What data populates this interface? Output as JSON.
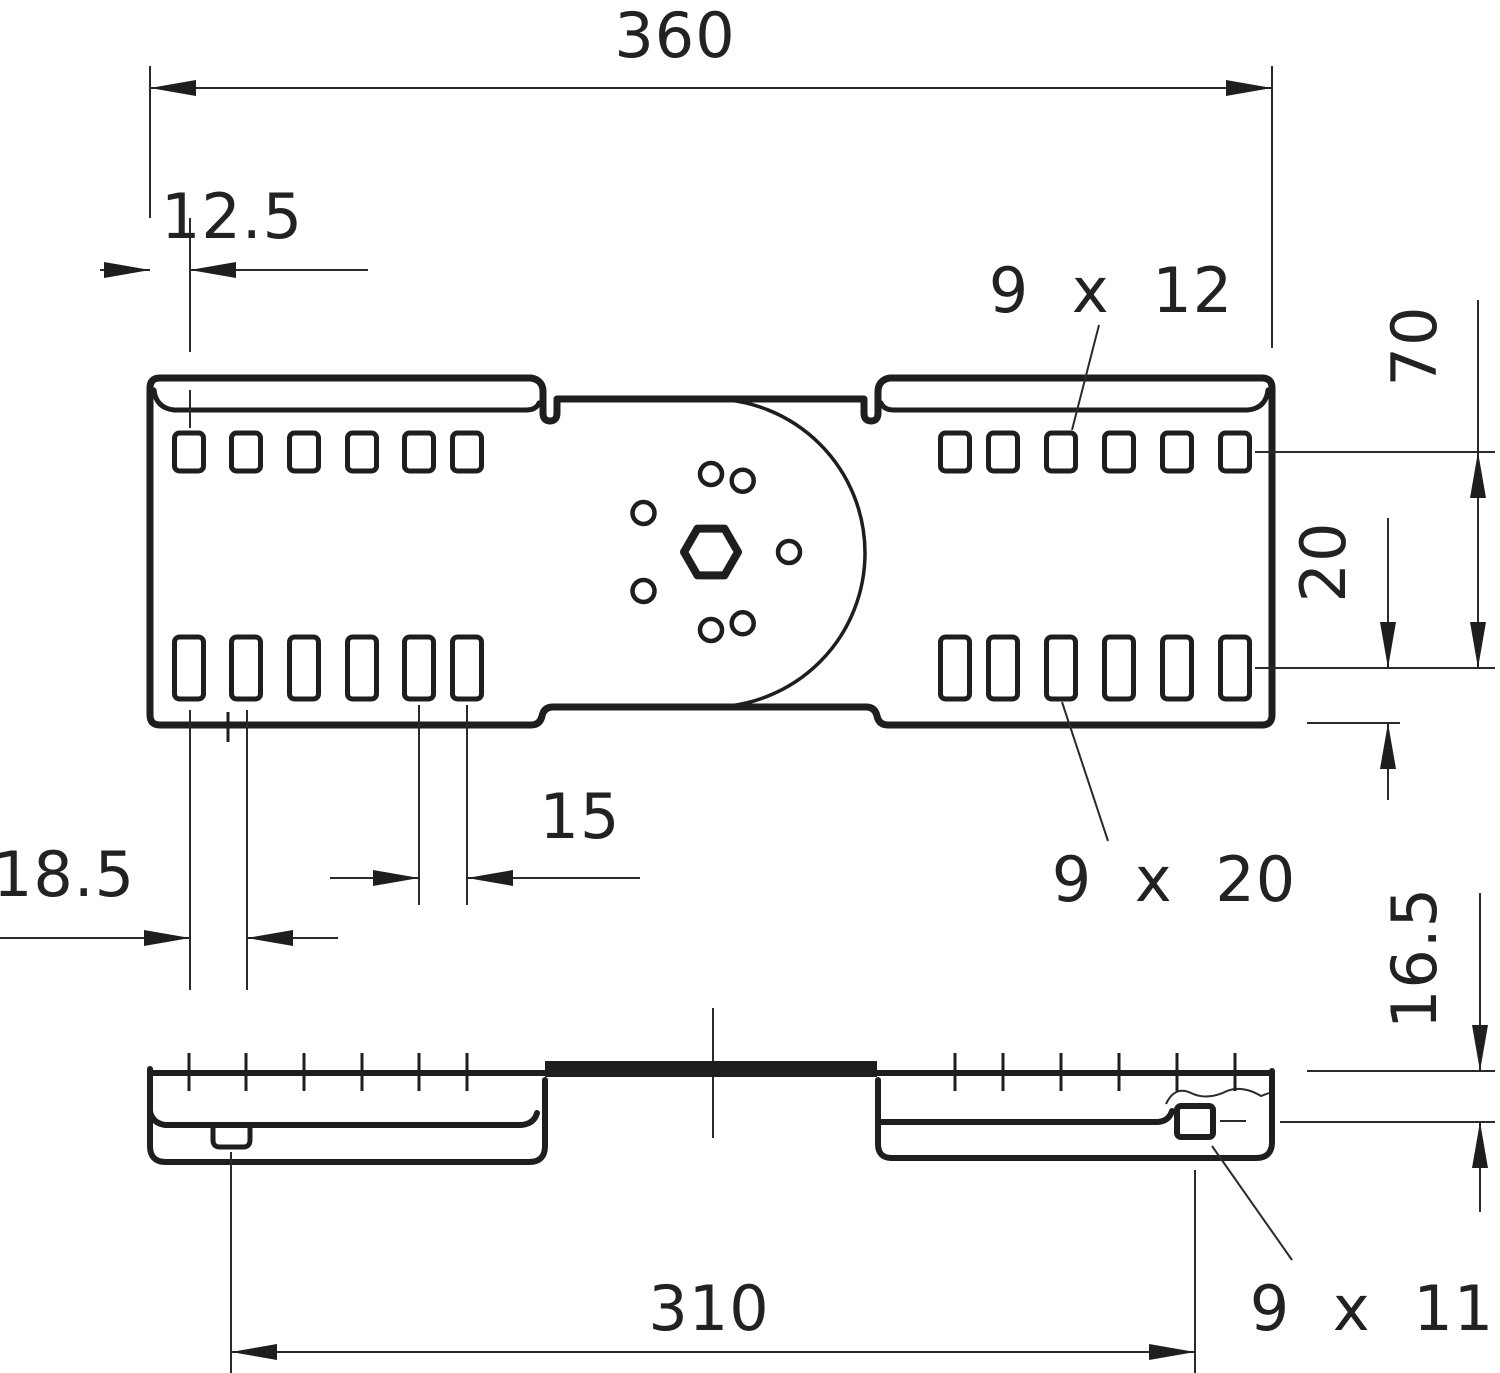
{
  "drawing": {
    "type": "technical-dimension-drawing",
    "views": [
      "top-view",
      "side-view"
    ],
    "dimensions": {
      "overall_width": "360",
      "edge_to_first_top_slot": "12.5",
      "top_slot_size": "9 x 12",
      "slot_row_spacing": "70",
      "bottom_row_to_edge": "20",
      "bottom_slot_size": "9 x 20",
      "first_bottom_slot_pitch": "18.5",
      "slot_pair_pitch": "15",
      "profile_step_height": "16.5",
      "fixing_centers_length": "310",
      "side_cutout_size": "9 x 11"
    },
    "line_color": "#1e1e1e",
    "background_color": "#ffffff"
  }
}
